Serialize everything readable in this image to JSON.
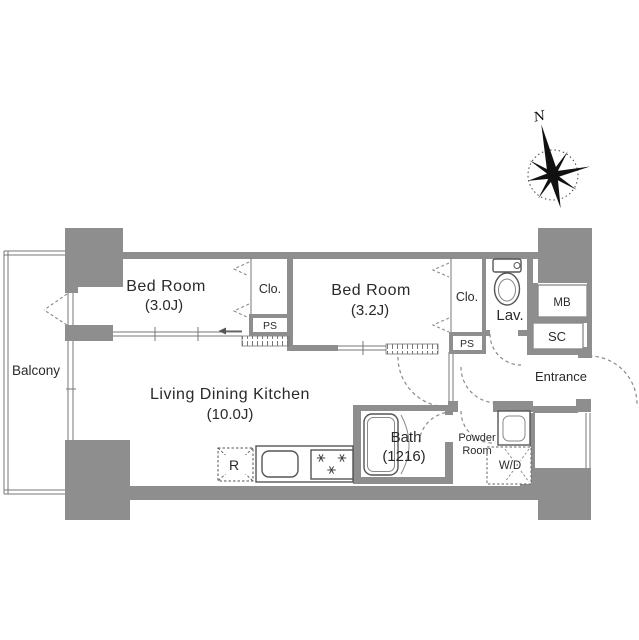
{
  "page": {
    "background": "#ffffff"
  },
  "colors": {
    "wall": "#8e8e8e",
    "thin_line": "#777777",
    "dash_line": "#8a8a8a",
    "fixture_outline": "#555555",
    "text": "#2a2a2a",
    "compass": "#111111"
  },
  "compass": {
    "north_label": "N"
  },
  "outdoor": {
    "balcony_label": "Balcony"
  },
  "rooms": {
    "bedroom1": {
      "name": "Bed Room",
      "size": "(3.0J)"
    },
    "bedroom2": {
      "name": "Bed Room",
      "size": "(3.2J)"
    },
    "living": {
      "name": "Living Dining Kitchen",
      "size": "(10.0J)"
    },
    "bath": {
      "name": "Bath",
      "size": "(1216)"
    },
    "powder_room": {
      "name_line1": "Powder",
      "name_line2": "Room"
    },
    "lavatory": {
      "name": "Lav."
    },
    "entrance": {
      "name": "Entrance"
    }
  },
  "storage": {
    "closet1": "Clo.",
    "closet2": "Clo.",
    "pipe_space1": "PS",
    "pipe_space2": "PS",
    "meter_box": "MB",
    "shoe_closet": "SC"
  },
  "appliances": {
    "refrigerator": "R",
    "washer_dryer": "W/D"
  }
}
